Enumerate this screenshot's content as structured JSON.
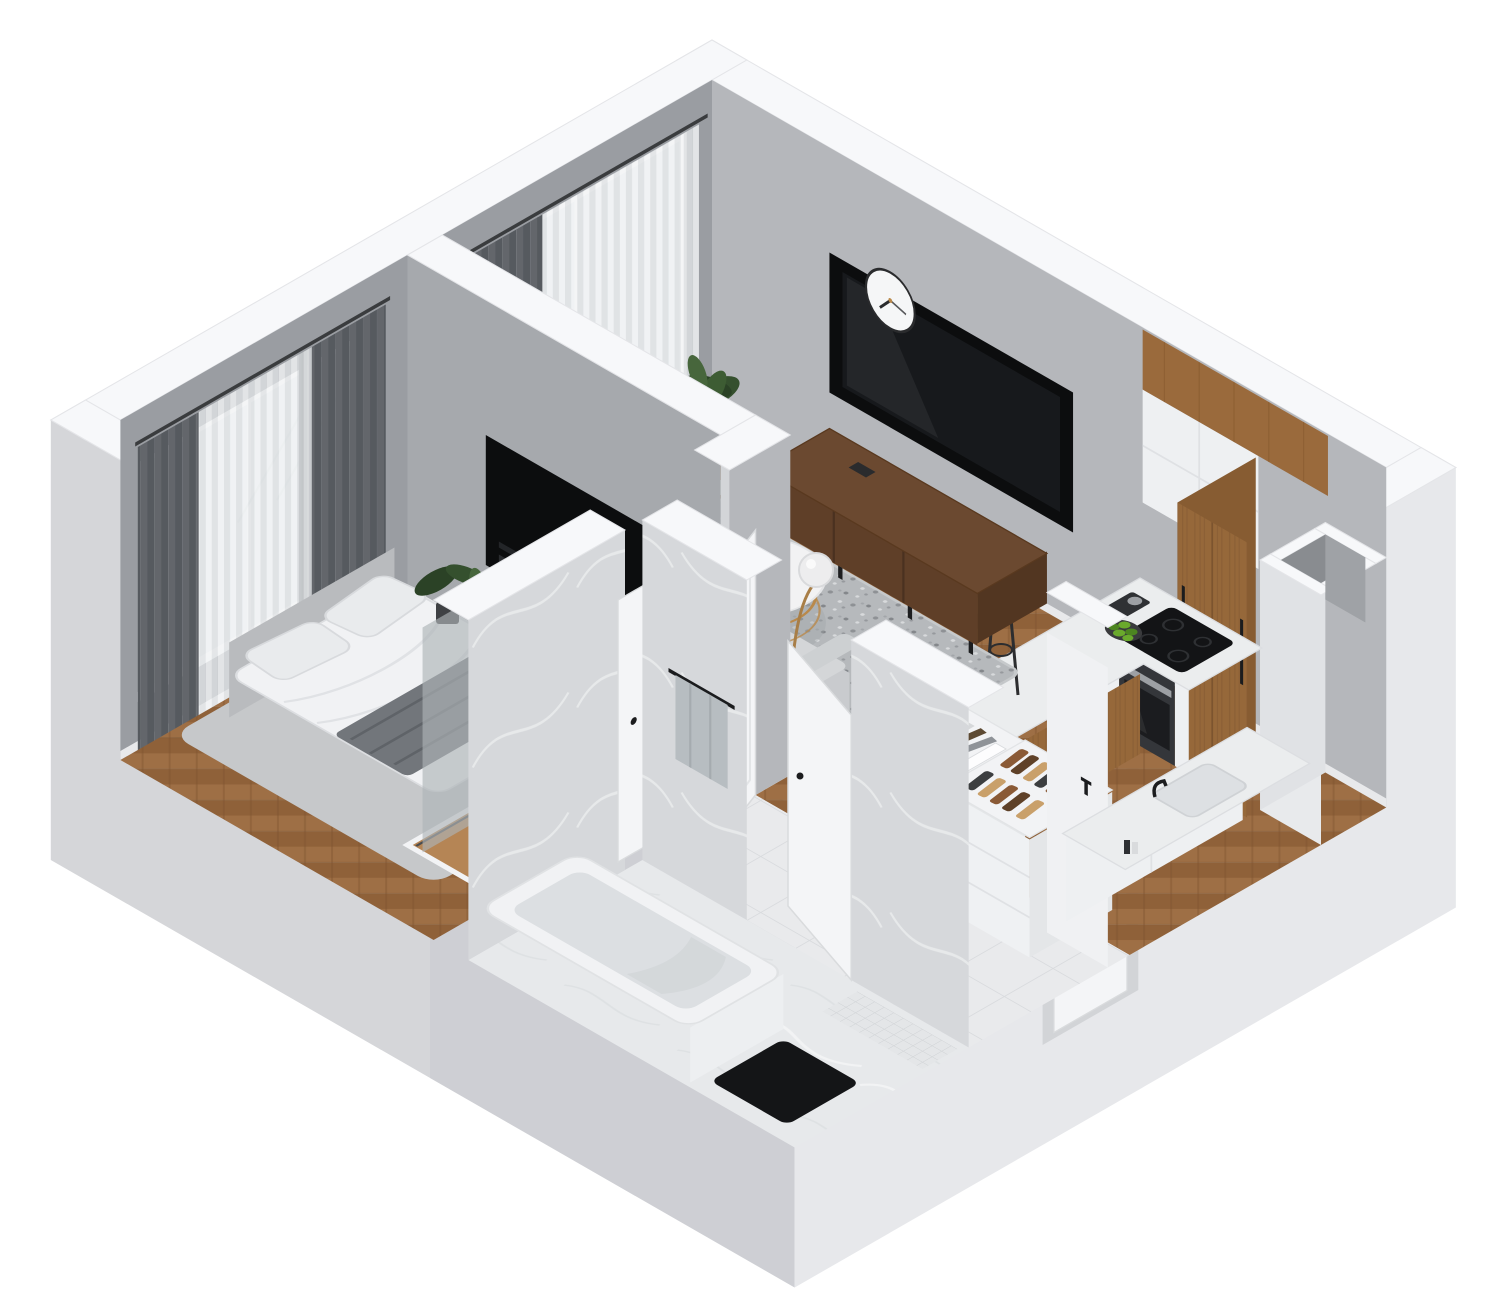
{
  "meta": {
    "type": "3d-apartment-floorplan-render",
    "view": "isometric-cutaway",
    "visible_text": "none"
  },
  "clock": {
    "time_shown": "approx 7:17"
  },
  "rooms": [
    {
      "id": "living-room",
      "furniture": [
        "sofa-with-chaise",
        "speckled-rug",
        "round-coffee-table-gold-base",
        "vase-with-dried-sprigs",
        "floor-lamp",
        "walnut-tv-console",
        "inset-wall-tv",
        "wall-clock",
        "potted-plant",
        "balcony-door-with-curtains"
      ]
    },
    {
      "id": "kitchen",
      "furniture": [
        "l-shaped-marble-counter",
        "bar-peninsula",
        "two-bar-stools",
        "fruit-bowl-green-apples",
        "coffee-maker",
        "black-cooktop",
        "built-in-oven",
        "tall-walnut-cabinets",
        "white-upper-cabinets",
        "wood-soffit-band",
        "corner-vent-shaft",
        "sink-counter-with-black-faucet"
      ]
    },
    {
      "id": "bedroom",
      "furniture": [
        "double-bed-white-duvet",
        "gray-throw-blanket",
        "pillows",
        "bedside-rug",
        "window-with-gray-drapes-and-sheers",
        "potted-plant",
        "tv-niche-in-partition",
        "sliding-door-wardrobe"
      ]
    },
    {
      "id": "bathroom",
      "furniture": [
        "bathtub",
        "marble-walls",
        "marble-floor",
        "towel-on-rail",
        "mosaic-floor-strip",
        "black-floor-mat",
        "white-door"
      ]
    },
    {
      "id": "hallway",
      "furniture": [
        "white-tile-floor",
        "bookshelf-with-books",
        "shoe-rack-with-shoes",
        "entry-door-in-recess",
        "open-interior-door",
        "wall-hook"
      ]
    },
    {
      "id": "balcony",
      "furniture": [
        "white-deck",
        "glass-balustrade"
      ]
    }
  ],
  "colors": {
    "bg": "#ffffff",
    "wallTop": "#f7f8fa",
    "wallEdge": "#e4e5e8",
    "outerSE": "#e7e8eb",
    "outerSW": "#d5d6d9",
    "outerSWdark": "#c9cbcf",
    "recess": "#d2d4d7",
    "intNE": "#b5b7bb",
    "intNW": "#9a9da2",
    "part": "#a6a9ad",
    "partEnd": "#d3d5d8",
    "baseboard": "#e8e9eb",
    "niche": "#0c0d0e",
    "tv": "#17191c",
    "clockFace": "#f5f6f7",
    "clockRim": "#2a2b2d",
    "woodA": "#9e6f45",
    "woodB": "#8f6139",
    "woodLine": "#7d5330",
    "tileBase": "#e9eaec",
    "tileLine": "#d9dbde",
    "marbleF": "#e7e9eb",
    "marbleW": "#d6d8db",
    "vein": "#f3f4f6",
    "rugBase": "#b6b9bc",
    "rugDot1": "#84878b",
    "rugDot2": "#d8dadc",
    "sofa": "#d4d6d8",
    "sofaBack": "#dddfe1",
    "sofaDark": "#c9cbce",
    "consoleWood": "#6b4930",
    "consoleFront": "#5f3f28",
    "consoleSide": "#523621",
    "gold": "#b9894b",
    "lampGold": "#a87e47",
    "globe": "#ededee",
    "tableTop": "#f2f2f3",
    "vase": "#eff0f2",
    "sprig": "#8a6d52",
    "plantD": "#35502e",
    "plantL": "#47663c",
    "pot": "#3f4144",
    "drape": "#63666b",
    "drapeDark": "#565a5f",
    "sheer": "#eceeef",
    "glass": "#dfe3e6",
    "kWood": "#96683a",
    "kWoodSide": "#875c32",
    "kWoodTop": "#9a6a3c",
    "cabWhite": "#eef0f2",
    "counter": "#ebedee",
    "counterEdge": "#dcdee1",
    "cooktop": "#131416",
    "oven": "#34363a",
    "steel": "#9da0a4",
    "apples": "#6aa92c",
    "applesDark": "#4c8520",
    "bowl": "#3a3b3d",
    "duvet": "#f1f2f4",
    "blanket": "#72767b",
    "blanketFold": "#5f6368",
    "pillow": "#e9ebed",
    "bedRug": "#c6c8ca",
    "headboard": "#b9bbbe",
    "closetWood": "#b58555",
    "glassPanel": "#aeb3b7",
    "doorWhite": "#f4f5f7",
    "doorEdge": "#d9dbdd",
    "handle": "#1b1c1e",
    "tub": "#f1f2f4",
    "tubIn": "#dcdfe2",
    "tubShade": "#d0d4d7",
    "matBlack": "#141517",
    "towel": "#b7bdc1",
    "shoeA": "#8a5a36",
    "shoeB": "#5f4128",
    "shoeC": "#c9a06a",
    "shoeD": "#3c3e40",
    "bookA": "#4a3b2c",
    "bookB": "#7b8187",
    "bookC": "#a05a33",
    "bookD": "#31343a",
    "ventIn": "#9fa2a6",
    "ventPit": "#898c90",
    "balcony": "#eef0f2",
    "balGlass": "#d6dde0",
    "railDark": "#4e5154"
  }
}
